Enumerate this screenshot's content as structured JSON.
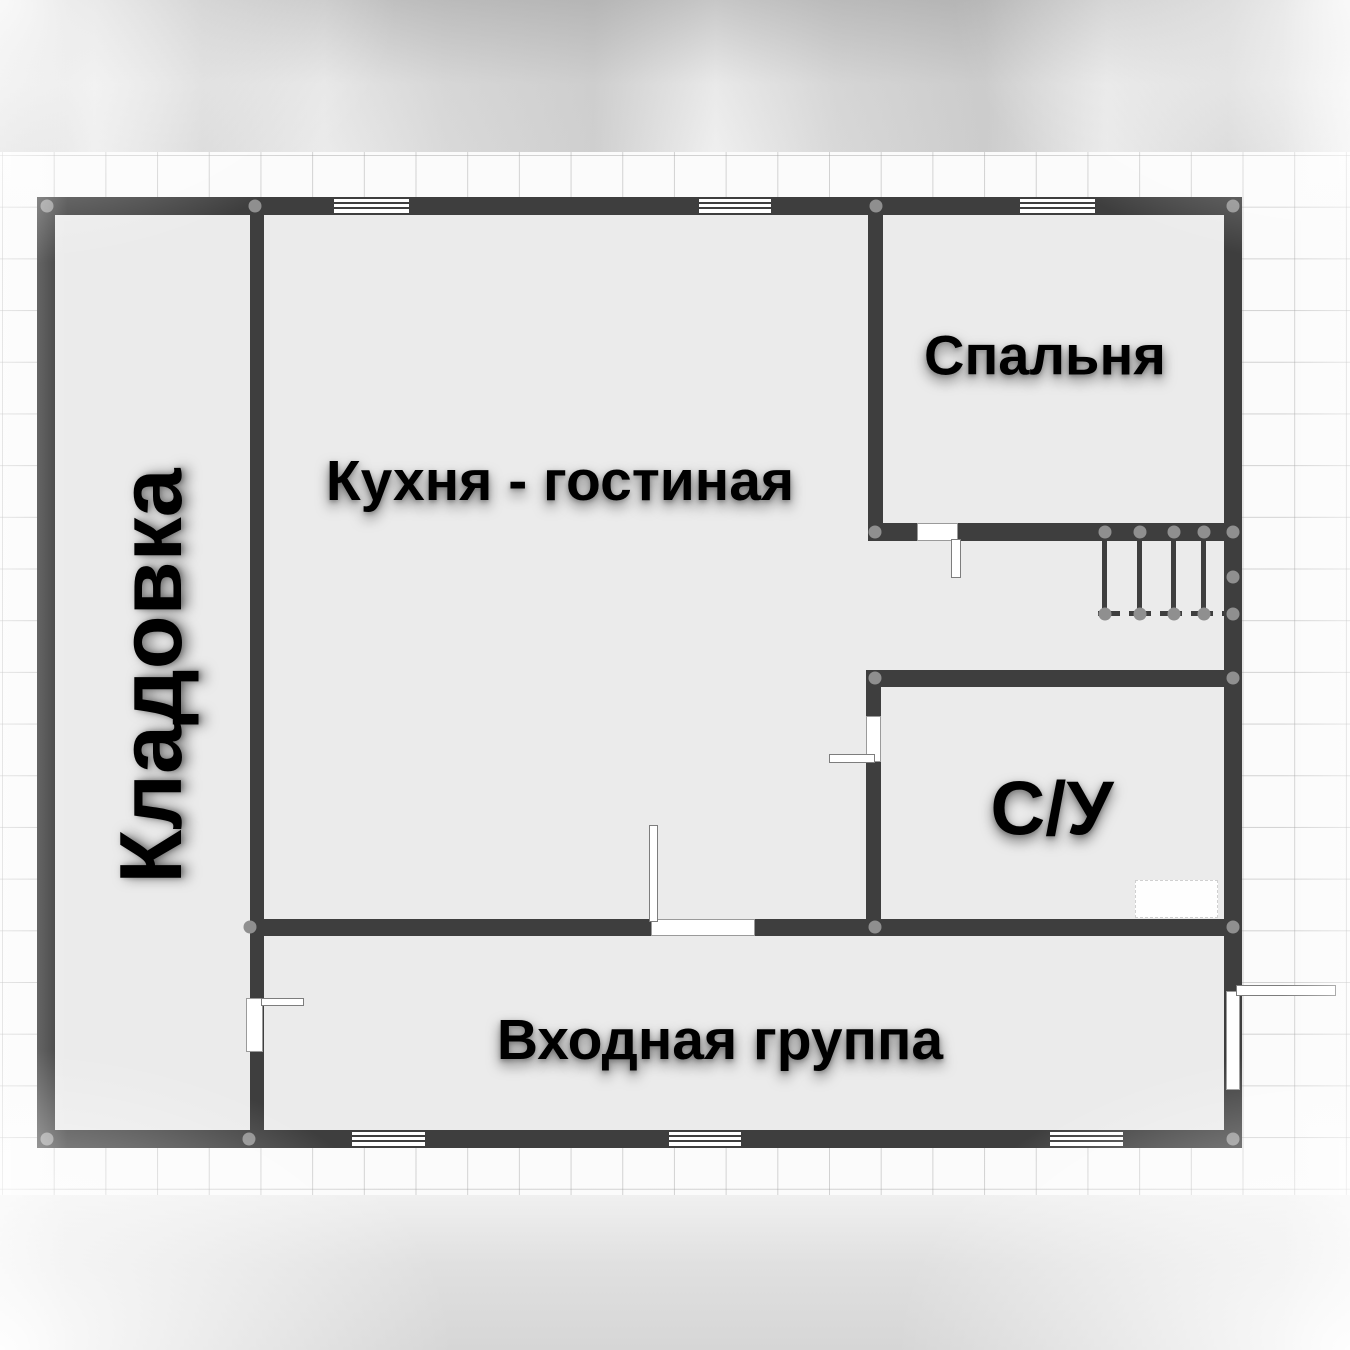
{
  "rooms": {
    "kladovka": {
      "label": "Кладовка"
    },
    "kitchen_living": {
      "label": "Кухня - гостиная"
    },
    "bedroom": {
      "label": "Спальня"
    },
    "bathroom": {
      "label": "С/У"
    },
    "entrance": {
      "label": "Входная группа"
    }
  },
  "colors": {
    "wall": "#3e3e3e",
    "room_fill": "#ebebeb",
    "grid_background": "#fbfbfb",
    "grid_line": "#a0a0a0",
    "junction_dot": "#8f8f8f",
    "window_fill": "#ffffff",
    "door_fill": "#ffffff",
    "label_text": "#000000"
  }
}
